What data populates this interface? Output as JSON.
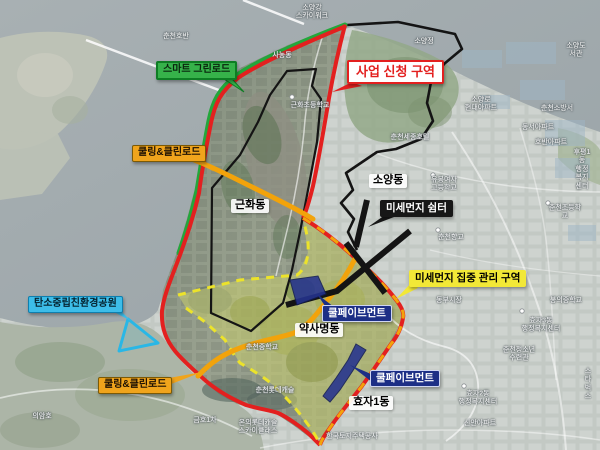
{
  "annotations": {
    "smart_greenroad": {
      "label": "스마트 그린로드"
    },
    "project_zone": {
      "label": "사업 신청 구역"
    },
    "cooling_clean_road_1": {
      "label": "쿨링&클린로드"
    },
    "cooling_clean_road_2": {
      "label": "쿨링&클린로드"
    },
    "geunhwa_dong": {
      "label": "근화동"
    },
    "soyang_dong": {
      "label": "소양동"
    },
    "dust_shelter": {
      "label": "미세먼지 쉼터"
    },
    "dust_zone": {
      "label": "미세먼지 집중 관리 구역"
    },
    "carbon_park": {
      "label": "탄소중립친환경공원"
    },
    "cool_pavement_1": {
      "label": "쿨페이브먼트"
    },
    "cool_pavement_2": {
      "label": "쿨페이브먼트"
    },
    "yaksamyeong_dong": {
      "label": "약사명동"
    },
    "hyoja1_dong": {
      "label": "효자1동"
    }
  },
  "place_labels": [
    {
      "text": "춘천호반",
      "x": 176,
      "y": 37
    },
    {
      "text": "소양강\n스카이워크",
      "x": 312,
      "y": 13
    },
    {
      "text": "소양정",
      "x": 424,
      "y": 42
    },
    {
      "text": "의암호",
      "x": 42,
      "y": 417
    },
    {
      "text": "사농동",
      "x": 282,
      "y": 56
    },
    {
      "text": "근화초등학교",
      "x": 310,
      "y": 106
    },
    {
      "text": "소양로\n현대아파트",
      "x": 481,
      "y": 105
    },
    {
      "text": "춘천세종호텔",
      "x": 410,
      "y": 138
    },
    {
      "text": "소양도서관",
      "x": 576,
      "y": 51
    },
    {
      "text": "춘천소방서",
      "x": 557,
      "y": 109
    },
    {
      "text": "동서아파트",
      "x": 538,
      "y": 128
    },
    {
      "text": "호반아파트",
      "x": 551,
      "y": 143
    },
    {
      "text": "후평1동\n행정복지센터",
      "x": 582,
      "y": 170
    },
    {
      "text": "춘천초등학교",
      "x": 565,
      "y": 213
    },
    {
      "text": "유봉여자\n고등학교",
      "x": 444,
      "y": 185
    },
    {
      "text": "춘천향교",
      "x": 451,
      "y": 238
    },
    {
      "text": "동부시장",
      "x": 449,
      "y": 301
    },
    {
      "text": "봉의중학교",
      "x": 566,
      "y": 301
    },
    {
      "text": "효자3동\n행정복지센터",
      "x": 541,
      "y": 326
    },
    {
      "text": "춘천청소년\n수련관",
      "x": 519,
      "y": 355
    },
    {
      "text": "스타벅스",
      "x": 588,
      "y": 385
    },
    {
      "text": "효자2동\n행정복지센터",
      "x": 478,
      "y": 399
    },
    {
      "text": "신안아파트",
      "x": 480,
      "y": 424
    },
    {
      "text": "춘천중학교",
      "x": 262,
      "y": 348
    },
    {
      "text": "춘천롯데캐슬",
      "x": 275,
      "y": 391
    },
    {
      "text": "금호1차",
      "x": 205,
      "y": 421
    },
    {
      "text": "온의롯데캐슬\n스카이클래스",
      "x": 258,
      "y": 428
    },
    {
      "text": "한국토지주택공사",
      "x": 352,
      "y": 437
    }
  ],
  "colors": {
    "project_boundary": "#e3201f",
    "green_road": "#23a73b",
    "cooling_road": "#f2a30b",
    "dust_zone_fill": "#cbcf70",
    "dust_zone_dash": "#ece32a",
    "cool_pavement": "#25338f",
    "carbon_park": "#29b7e6",
    "admin_line": "#141414",
    "water": "#a2abae"
  }
}
